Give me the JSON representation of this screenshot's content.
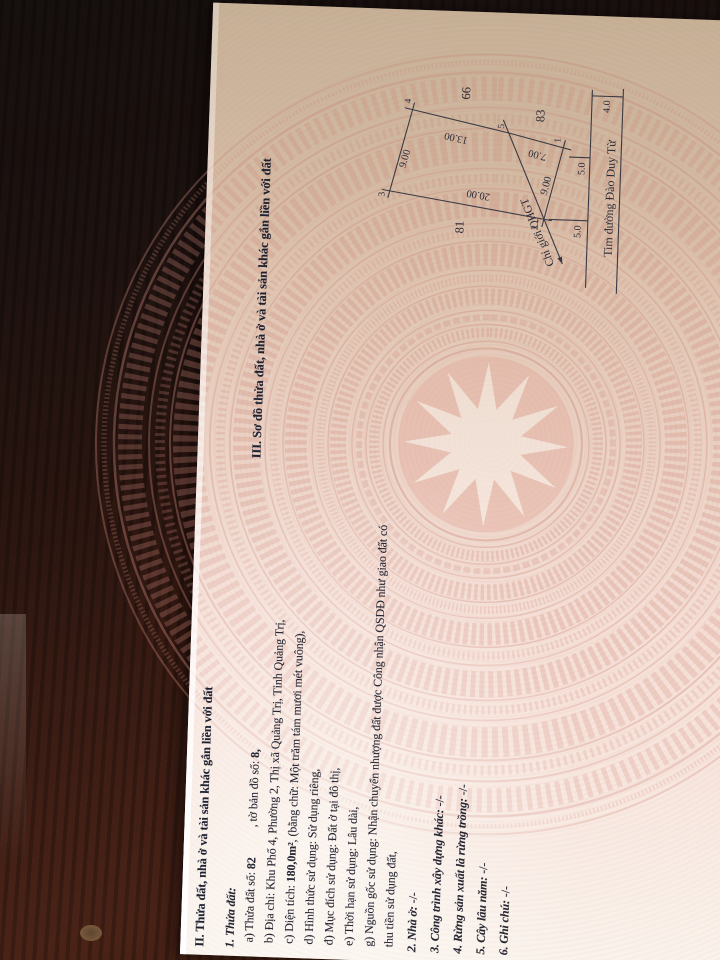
{
  "colors": {
    "table_wood": "#2a1510",
    "document_paper": "#f3dcd3",
    "drum_pattern_red": "#d28c7e",
    "floor": "#bcb9a3",
    "ink": "#262631"
  },
  "section2": {
    "heading": "II. Thửa đất, nhà ở và tài sản khác gắn liền với đất",
    "item1_label": "1. Thửa đất:",
    "a_label": "a) Thửa đất số:",
    "a_value": "82",
    "a_label2": ", tờ bản đồ số:",
    "a_value2": "8,",
    "b": "b) Địa chỉ: Khu Phố 4, Phường 2, Thị xã Quảng Trị, Tỉnh Quảng Trị,",
    "c_label": "c) Diện tích:",
    "c_value": "180,0m²",
    "c_rest": ", (bằng chữ: Một trăm tám mươi mét vuông),",
    "d": "d) Hình thức sử dụng: Sử dụng riêng,",
    "dd": "đ) Mục đích sử dụng: Đất ở tại đô thị,",
    "e": "e) Thời hạn sử dụng: Lâu dài,",
    "g": "g) Nguồn gốc sử dụng: Nhận chuyển nhượng đất được Công nhận QSDĐ như giao đất có",
    "g2": "thu tiền sử dụng đất,",
    "items": [
      {
        "label": "2. Nhà ở:",
        "value": "-/-"
      },
      {
        "label": "3. Công trình xây dựng khác:",
        "value": "-/-"
      },
      {
        "label": "4. Rừng sản xuất là rừng trồng:",
        "value": "-/-"
      },
      {
        "label": "5. Cây lâu năm:",
        "value": "-/-"
      },
      {
        "label": "6. Ghi chú:",
        "value": "-/-"
      }
    ]
  },
  "section3": {
    "heading": "III. Sơ đồ thửa đất, nhà ở và tài sản khác gắn liền với đất",
    "diagram": {
      "vertex_labels": {
        "v1": "1",
        "v2": "2",
        "v3": "3",
        "v4": "4",
        "v5": "5"
      },
      "edge_dims": {
        "e34": "9.00",
        "e45": "13.00",
        "e51": "7.00",
        "e12": "9.00",
        "e23": "20.00"
      },
      "setback_dims": {
        "s1": "5.0",
        "s2": "5.0",
        "road_half": "4.0"
      },
      "neighbor_plots": {
        "left": "81",
        "right_upper": "66",
        "right_lower": "83"
      },
      "planning_boundary": "Chỉ giới QHGT",
      "road_centerline": "Tim đường Đào Duy Từ"
    }
  }
}
